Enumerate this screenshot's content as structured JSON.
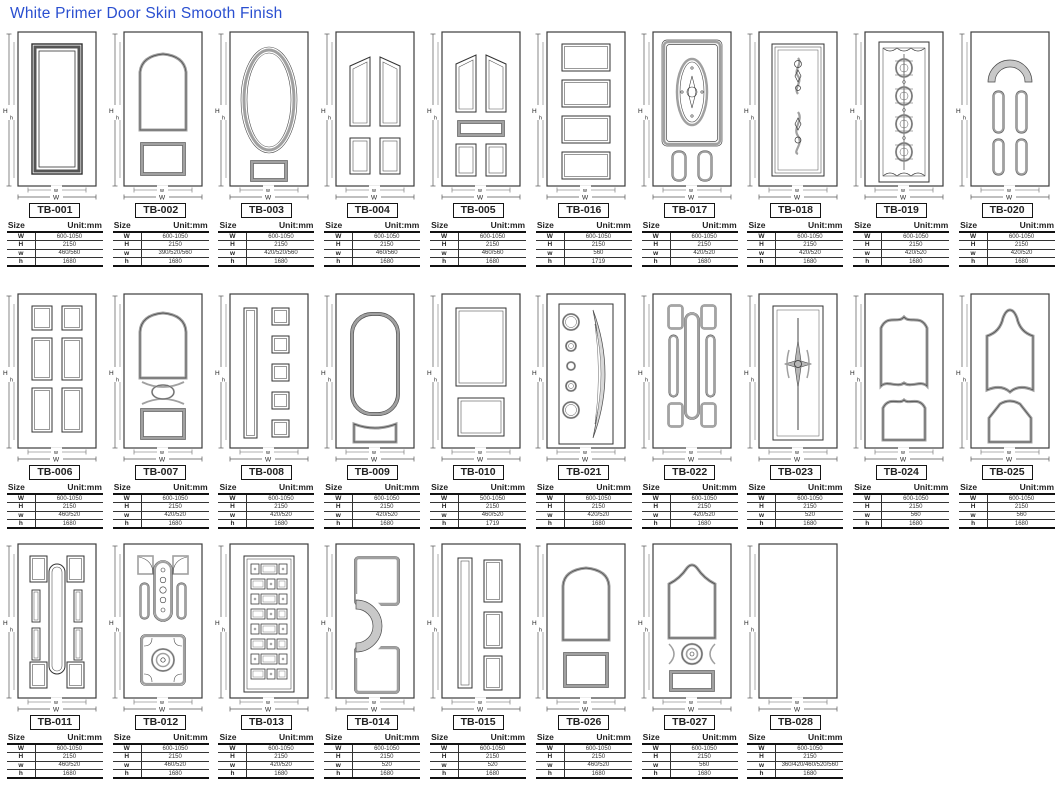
{
  "page": {
    "title": "White Primer Door Skin Smooth Finish",
    "accent_color": "#2a4fd0"
  },
  "table_header": {
    "size_label": "Size",
    "unit_label": "Unit:mm"
  },
  "table_row_keys": [
    "W",
    "H",
    "w",
    "h"
  ],
  "dim_labels": {
    "H": "H",
    "h": "h",
    "w": "w",
    "W": "W"
  },
  "rows": [
    [
      0,
      1,
      2,
      3,
      4,
      15,
      16,
      17,
      18,
      19
    ],
    [
      5,
      6,
      7,
      8,
      9,
      20,
      21,
      22,
      23,
      24
    ],
    [
      10,
      11,
      12,
      13,
      14,
      25,
      26,
      27
    ]
  ],
  "doors": [
    {
      "id": "TB-001",
      "design": "single-panel",
      "values": {
        "W": "600-1050",
        "H": "2150",
        "w": "460/560",
        "h": "1680"
      }
    },
    {
      "id": "TB-002",
      "design": "arch-two-panel",
      "values": {
        "W": "600-1050",
        "H": "2150",
        "w": "390/520/560",
        "h": "1680"
      }
    },
    {
      "id": "TB-003",
      "design": "oval-panel",
      "values": {
        "W": "600-1050",
        "H": "2150",
        "w": "420/520/560",
        "h": "1680"
      }
    },
    {
      "id": "TB-004",
      "design": "four-panel-cathedral",
      "values": {
        "W": "600-1050",
        "H": "2150",
        "w": "460/560",
        "h": "1680"
      }
    },
    {
      "id": "TB-005",
      "design": "five-panel-cathedral",
      "values": {
        "W": "600-1050",
        "H": "2150",
        "w": "460/560",
        "h": "1680"
      }
    },
    {
      "id": "TB-006",
      "design": "six-panel",
      "values": {
        "W": "600-1050",
        "H": "2150",
        "w": "460/520",
        "h": "1680"
      }
    },
    {
      "id": "TB-007",
      "design": "arch-oval-square",
      "values": {
        "W": "600-1050",
        "H": "2150",
        "w": "420/520",
        "h": "1680"
      }
    },
    {
      "id": "TB-008",
      "design": "slot-five-square",
      "values": {
        "W": "600-1050",
        "H": "2150",
        "w": "420/520",
        "h": "1680"
      }
    },
    {
      "id": "TB-009",
      "design": "round-arch-two-panel",
      "values": {
        "W": "600-1050",
        "H": "2150",
        "w": "420/520",
        "h": "1680"
      }
    },
    {
      "id": "TB-010",
      "design": "two-panel-flat",
      "values": {
        "W": "500-1050",
        "H": "2150",
        "w": "460/520",
        "h": "1719"
      }
    },
    {
      "id": "TB-011",
      "design": "obround-eight-panel",
      "values": {
        "W": "600-1050",
        "H": "2150",
        "w": "460/520",
        "h": "1680"
      }
    },
    {
      "id": "TB-012",
      "design": "ornate-geometric",
      "values": {
        "W": "600-1050",
        "H": "2150",
        "w": "460/520",
        "h": "1680"
      }
    },
    {
      "id": "TB-013",
      "design": "brick-pattern",
      "values": {
        "W": "600-1050",
        "H": "2150",
        "w": "420/520",
        "h": "1680"
      }
    },
    {
      "id": "TB-014",
      "design": "fan-swoosh-two-panel",
      "values": {
        "W": "600-1050",
        "H": "2150",
        "w": "520",
        "h": "1680"
      }
    },
    {
      "id": "TB-015",
      "design": "slot-three-rect",
      "values": {
        "W": "600-1050",
        "H": "2150",
        "w": "520",
        "h": "1680"
      }
    },
    {
      "id": "TB-016",
      "design": "four-horizontal-panel",
      "values": {
        "W": "600-1050",
        "H": "2150",
        "w": "560",
        "h": "1719"
      }
    },
    {
      "id": "TB-017",
      "design": "oval-medallion-two-slot",
      "values": {
        "W": "600-1050",
        "H": "2150",
        "w": "420/520",
        "h": "1680"
      }
    },
    {
      "id": "TB-018",
      "design": "scroll-ornament-panel",
      "values": {
        "W": "600-1050",
        "H": "2150",
        "w": "420/520",
        "h": "1680"
      }
    },
    {
      "id": "TB-019",
      "design": "barrel-column-panel",
      "values": {
        "W": "600-1050",
        "H": "2150",
        "w": "420/520",
        "h": "1680"
      }
    },
    {
      "id": "TB-020",
      "design": "fan-top-four-slot",
      "values": {
        "W": "600-1050",
        "H": "2150",
        "w": "420/520",
        "h": "1680"
      }
    },
    {
      "id": "TB-021",
      "design": "circles-crescent",
      "values": {
        "W": "600-1050",
        "H": "2150",
        "w": "420/520",
        "h": "1680"
      }
    },
    {
      "id": "TB-022",
      "design": "obround-six-panel",
      "values": {
        "W": "600-1050",
        "H": "2150",
        "w": "420/520",
        "h": "1680"
      }
    },
    {
      "id": "TB-023",
      "design": "star-center-panel",
      "values": {
        "W": "600-1050",
        "H": "2150",
        "w": "520",
        "h": "1680"
      }
    },
    {
      "id": "TB-024",
      "design": "ogee-two-panel",
      "values": {
        "W": "600-1050",
        "H": "2150",
        "w": "560",
        "h": "1680"
      }
    },
    {
      "id": "TB-025",
      "design": "gothic-two-panel",
      "values": {
        "W": "600-1050",
        "H": "2150",
        "w": "560",
        "h": "1680"
      }
    },
    {
      "id": "TB-026",
      "design": "arch-two-panel-b",
      "values": {
        "W": "600-1050",
        "H": "2150",
        "w": "460/520",
        "h": "1680"
      }
    },
    {
      "id": "TB-027",
      "design": "arch-circle-panel",
      "values": {
        "W": "600-1050",
        "H": "2150",
        "w": "560",
        "h": "1680"
      }
    },
    {
      "id": "TB-028",
      "design": "flush",
      "values": {
        "W": "600-1050",
        "H": "2150",
        "w": "360/420/460/520/560",
        "h": "1680"
      }
    }
  ]
}
